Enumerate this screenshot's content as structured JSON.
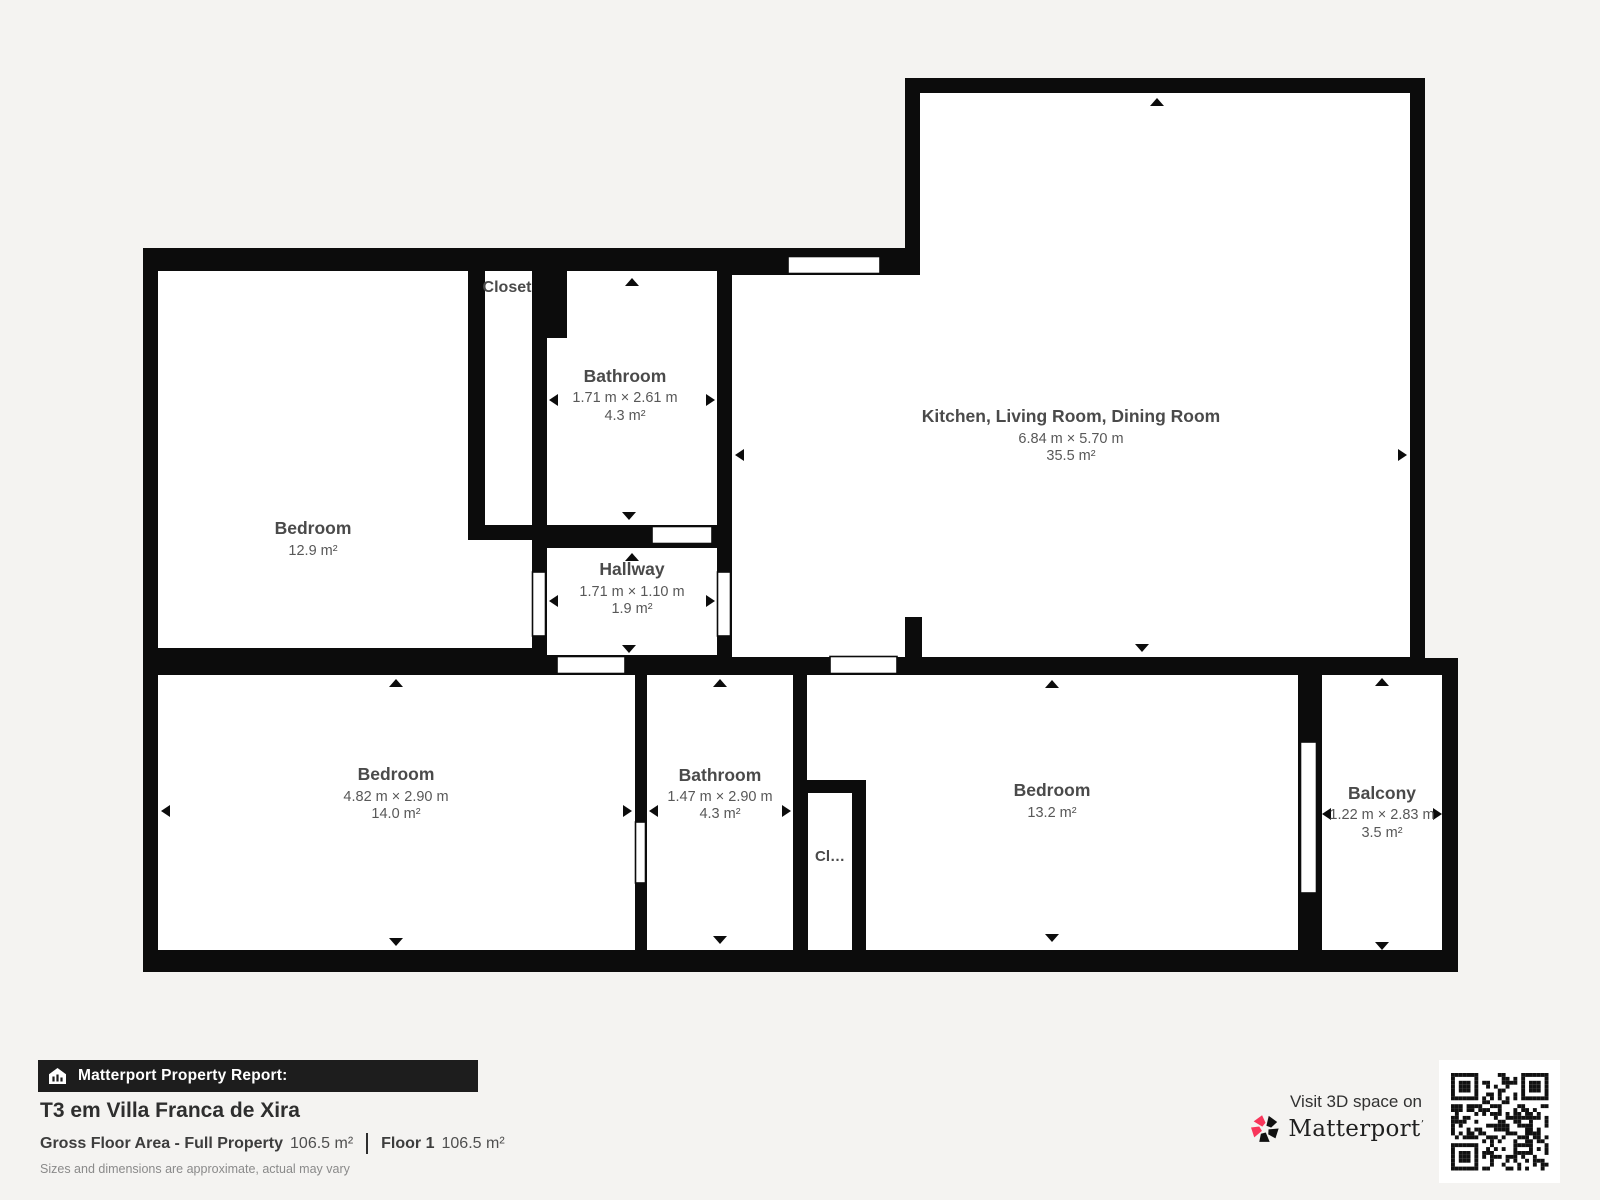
{
  "plan": {
    "rooms": {
      "bedroom_top_left": {
        "name": "Bedroom",
        "area": "12.9 m²"
      },
      "closet_top": {
        "name": "Closet"
      },
      "bathroom_top": {
        "name": "Bathroom",
        "dims": "1.71 m × 2.61 m",
        "area": "4.3 m²"
      },
      "hallway": {
        "name": "Hallway",
        "dims": "1.71 m × 1.10 m",
        "area": "1.9 m²"
      },
      "kitchen_living_dining": {
        "name": "Kitchen, Living Room, Dining Room",
        "dims": "6.84 m × 5.70 m",
        "area": "35.5 m²"
      },
      "bedroom_bottom_left": {
        "name": "Bedroom",
        "dims": "4.82 m × 2.90 m",
        "area": "14.0 m²"
      },
      "bathroom_bottom": {
        "name": "Bathroom",
        "dims": "1.47 m × 2.90 m",
        "area": "4.3 m²"
      },
      "closet_bottom": {
        "name": "Cl…"
      },
      "bedroom_bottom_right": {
        "name": "Bedroom",
        "area": "13.2 m²"
      },
      "balcony": {
        "name": "Balcony",
        "dims": "1.22 m × 2.83 m",
        "area": "3.5 m²"
      }
    }
  },
  "footer": {
    "report_label": "Matterport Property Report:",
    "property_title": "T3 em Villa Franca de Xira",
    "gfa_label": "Gross Floor Area - Full Property",
    "gfa_value": "106.5 m²",
    "floor_label": "Floor 1",
    "floor_value": "106.5 m²",
    "disclaimer": "Sizes and dimensions are approximate, actual may vary"
  },
  "brand": {
    "visit_label": "Visit 3D space on",
    "name": "Matterport",
    "mark": "ʼ"
  },
  "icons": {
    "report_icon": "house-icon",
    "brand_icon": "matterport-pinwheel-icon",
    "qr": "qr-code"
  },
  "colors": {
    "background": "#f4f3f1",
    "wall": "#0c0c0c",
    "room_fill": "#ffffff",
    "label_text": "#4a4a4a",
    "brand_pink": "#f8365b",
    "bar_background": "#1d1d1d"
  }
}
